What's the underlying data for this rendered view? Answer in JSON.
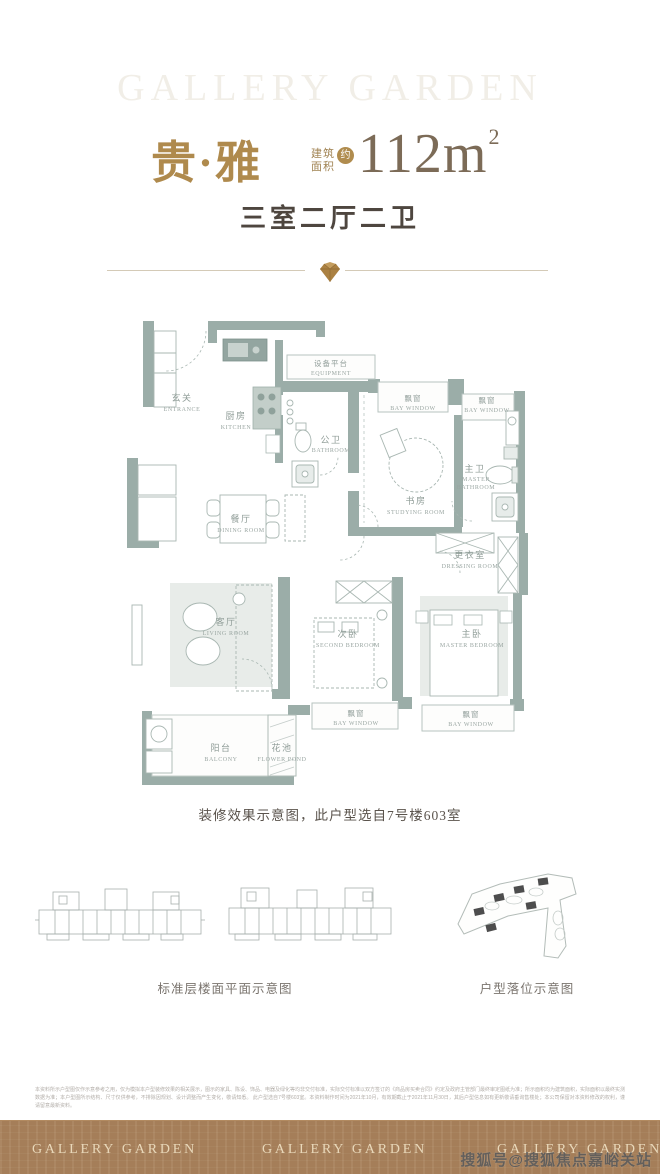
{
  "header": {
    "brand_ghost": "GALLERY GARDEN",
    "unit_name": "贵·雅",
    "area_label_line1": "建筑",
    "area_label_line2": "面积",
    "area_approx": "约",
    "area_value": "112m",
    "area_sup": "2",
    "layout": "三室二厅二卫"
  },
  "plan": {
    "caption": "装修效果示意图，此户型选自7号楼603室",
    "rooms": [
      {
        "zh": "玄关",
        "en": "ENTRANCE"
      },
      {
        "zh": "厨房",
        "en": "KITCHEN"
      },
      {
        "zh": "设备平台",
        "en": "EQUIPMENT"
      },
      {
        "zh": "公卫",
        "en": "BATHROOM"
      },
      {
        "zh": "飘窗",
        "en": "BAY WINDOW"
      },
      {
        "zh": "飘窗",
        "en": "BAY WINDOW"
      },
      {
        "zh": "书房",
        "en": "STUDYING ROOM"
      },
      {
        "zh": "主卫",
        "en1": "MASTER",
        "en2": "BATHROOM"
      },
      {
        "zh": "餐厅",
        "en": "DINING ROOM"
      },
      {
        "zh": "更衣室",
        "en": "DRESSING ROOM"
      },
      {
        "zh": "客厅",
        "en": "LIVING ROOM"
      },
      {
        "zh": "次卧",
        "en": "SECOND BEDROOM"
      },
      {
        "zh": "主卧",
        "en": "MASTER BEDROOM"
      },
      {
        "zh": "飘窗",
        "en": "BAY WINDOW"
      },
      {
        "zh": "飘窗",
        "en": "BAY WINDOW"
      },
      {
        "zh": "阳台",
        "en": "BALCONY"
      },
      {
        "zh": "花池",
        "en": "FLOWER POND"
      }
    ]
  },
  "diagrams": {
    "left_caption": "标准层楼面平面示意图",
    "right_caption": "户型落位示意图"
  },
  "disclaimer": {
    "line1": "本资料所示户型图仅作示意参考之用，仅为模拟本户型装修效果的相关展示，图示的家具、陈设、饰品、电器及绿化等均非交付标准，实际交付标准以双方签订的《商品房买卖合同》约定及政府主管部门最终审定图纸为准；所示面积均为建筑面积，实际面积以最终实测数据为准；本户型图所示结构、尺寸仅供参考，不排除因规划、设计调整而产生变化，敬请知悉。",
    "line2": "此户型选自7号楼603室。本资料制作时间为2021年10月，有效期截止于2021年11月30日，其后户型信息如有更新敬请垂询售楼处；本公司保留对本资料修改的权利，谨请留意最新资料。"
  },
  "footer": {
    "brand": "GALLERY GARDEN"
  },
  "watermark": {
    "text": "搜狐号@搜狐焦点嘉峪关站"
  },
  "colors": {
    "gold": "#af8a4d",
    "area_text": "#7c6b57",
    "wall": "#9bada8",
    "footer_bg": "#a8815b",
    "label": "#8e9b96"
  }
}
